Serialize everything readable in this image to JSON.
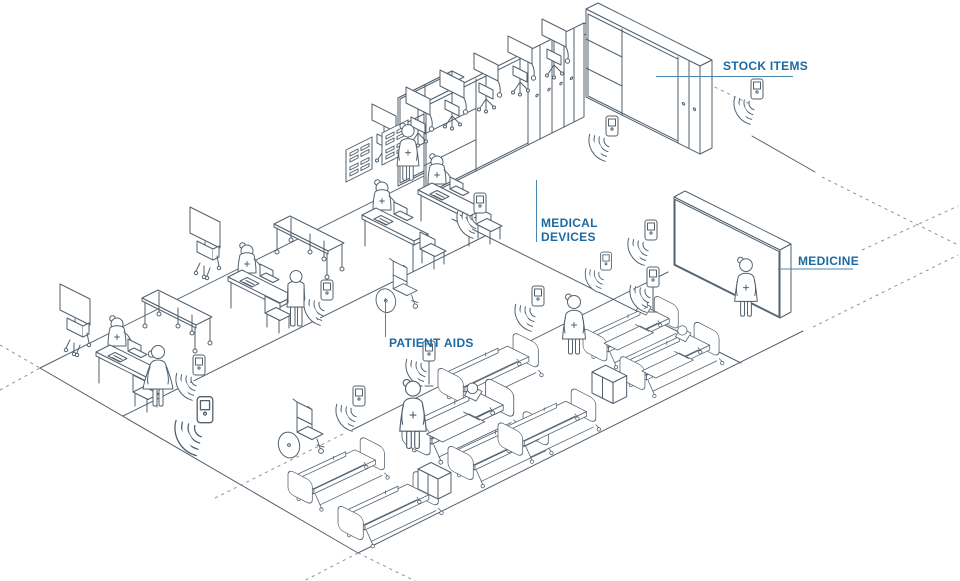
{
  "title": "Hospital asset tracking isometric illustration",
  "labels": {
    "stock_items": "STOCK ITEMS",
    "medical_devices_line1": "MEDICAL",
    "medical_devices_line2": "DEVICES",
    "medicine": "MEDICINE",
    "patient_aids": "PATIENT AIDS"
  },
  "colors": {
    "background": "#ffffff",
    "line_art": "#52616e",
    "label_text": "#1b6aa3",
    "leader_line": "#4a85b0",
    "signal_waves": "#8fc0da",
    "dashed_line": "#8a949c"
  },
  "zones": [
    {
      "label": "STOCK ITEMS",
      "description": "L-shaped storage shelving with bins and lockers"
    },
    {
      "label": "MEDICAL DEVICES",
      "description": "row of monitors on wheeled stands"
    },
    {
      "label": "MEDICINE",
      "description": "wall cabinet with medicine compartments and nurse"
    },
    {
      "label": "PATIENT AIDS",
      "description": "wheelchairs and hospital beds in the ward"
    }
  ],
  "objects": {
    "hospital_beds": 8,
    "occupied_beds": 3,
    "wheelchairs": 2,
    "consultation_desks": 4,
    "monitor_carts": 2,
    "exam_tables": 2,
    "device_stands": 6,
    "xray_viewers": 2,
    "staff_figures": 8,
    "patient_figures": 5,
    "rfid_sensor_tags": 12,
    "supply_boxes": 2
  }
}
